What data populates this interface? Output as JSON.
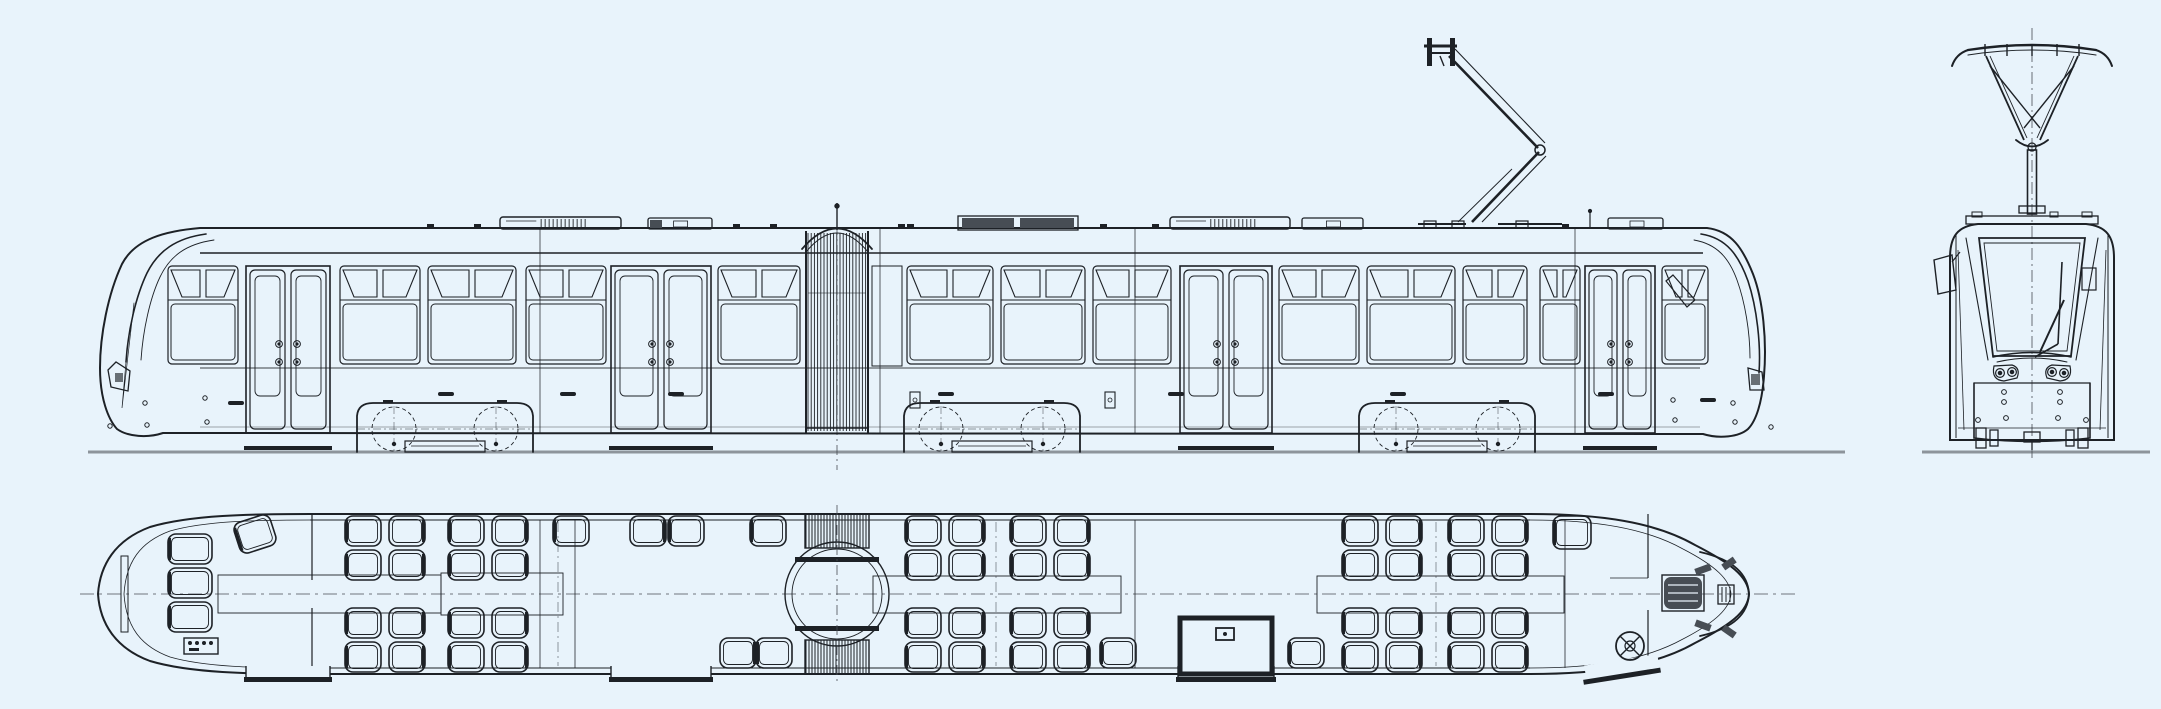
{
  "canvas": {
    "width": 2161,
    "height": 709,
    "background": "#e8f3fb",
    "ink": "#1d2126",
    "ink_soft": "#474d54",
    "ground": "#8d949b"
  },
  "side_view": {
    "rail_y": 452,
    "roof_y": 228,
    "body_bottom": 433,
    "fascia_y": 253,
    "waist_y": 368,
    "body": {
      "left_tip": 100,
      "right_tip": 1764,
      "roof_left": 200,
      "roof_right": 1707
    },
    "center_mark_x": 837,
    "windows": [
      {
        "x": 166,
        "w": 74
      },
      {
        "x": 338,
        "w": 84
      },
      {
        "x": 426,
        "w": 92
      },
      {
        "x": 524,
        "w": 84
      },
      {
        "x": 716,
        "w": 86
      },
      {
        "x": 905,
        "w": 90
      },
      {
        "x": 999,
        "w": 88
      },
      {
        "x": 1091,
        "w": 82
      },
      {
        "x": 1277,
        "w": 84
      },
      {
        "x": 1365,
        "w": 92
      },
      {
        "x": 1461,
        "w": 68
      },
      {
        "x": 1538,
        "w": 44
      },
      {
        "x": 1660,
        "w": 50
      }
    ],
    "doors": [
      {
        "x": 246,
        "w": 84
      },
      {
        "x": 611,
        "w": 100
      },
      {
        "x": 1180,
        "w": 92
      },
      {
        "x": 1585,
        "w": 70
      }
    ],
    "filler_panels": [
      {
        "x": 872,
        "w": 30
      }
    ],
    "bogies": [
      {
        "cx": 445
      },
      {
        "cx": 992
      },
      {
        "cx": 1447
      }
    ],
    "bellows": {
      "x": 806,
      "w": 62,
      "dome_peak_y": 212,
      "spike_top_y": 203
    },
    "roof_units": [
      {
        "type": "louver",
        "x": 500,
        "w": 121
      },
      {
        "type": "box",
        "x": 648,
        "w": 64,
        "dark_end": "w"
      },
      {
        "type": "dark",
        "x": 958,
        "w": 120
      },
      {
        "type": "louver",
        "x": 1170,
        "w": 120
      },
      {
        "type": "box",
        "x": 1302,
        "w": 61
      },
      {
        "type": "box",
        "x": 1608,
        "w": 55
      }
    ],
    "roof_vents": [
      427,
      474,
      733,
      770,
      898,
      907,
      1100,
      1152,
      1562
    ],
    "antenna_x": 1590,
    "handles": [
      438,
      560,
      668,
      938,
      1168,
      1390,
      1598
    ],
    "latch_boxes": [
      910,
      1105
    ],
    "joints": [
      540,
      880,
      1135,
      1575
    ]
  },
  "front_view": {
    "cx": 2032,
    "rail_y": 452,
    "body": {
      "left": 1950,
      "right": 2114,
      "top": 224,
      "bottom": 440
    },
    "windshield": [
      [
        1979,
        238
      ],
      [
        2085,
        238
      ],
      [
        2071,
        356
      ],
      [
        1993,
        356
      ]
    ],
    "windshield_inner": [
      [
        1984,
        243
      ],
      [
        2080,
        243
      ],
      [
        2067,
        351
      ],
      [
        1997,
        351
      ]
    ],
    "headlight_centers": [
      [
        2000,
        373
      ],
      [
        2012,
        372
      ],
      [
        2052,
        372
      ],
      [
        2064,
        373
      ]
    ],
    "bumper_dots": [
      [
        2004,
        392
      ],
      [
        2060,
        392
      ],
      [
        2004,
        402
      ],
      [
        2060,
        402
      ],
      [
        2006,
        418
      ],
      [
        2058,
        418
      ],
      [
        1978,
        420
      ],
      [
        2086,
        420
      ]
    ],
    "mirror": [
      [
        1934,
        260
      ],
      [
        1952,
        255
      ],
      [
        1956,
        290
      ],
      [
        1938,
        294
      ]
    ],
    "dest_box": {
      "x": 2082,
      "y": 268,
      "w": 14,
      "h": 22
    },
    "pantograph": {
      "bow_y": 46,
      "bow_half": 64,
      "frame_bot_y": 140,
      "mast_top": 150,
      "mast_bottom": 214
    }
  },
  "plan_view": {
    "center_y": 594,
    "top_wall": 514,
    "bottom_wall": 674,
    "left_tip": 98,
    "right_tip": 1749,
    "straight": [
      310,
      1530
    ],
    "aisles": [
      {
        "x": 218,
        "y": 575,
        "w": 223,
        "h": 38
      },
      {
        "x": 441,
        "y": 573,
        "w": 122,
        "h": 42
      },
      {
        "x": 873,
        "y": 576,
        "w": 248,
        "h": 37
      },
      {
        "x": 1317,
        "y": 576,
        "w": 247,
        "h": 37
      }
    ],
    "bogie_marks": [
      558,
      996,
      1436
    ],
    "partitions": [
      540,
      575,
      1135,
      1565
    ],
    "articulation": {
      "x": 805,
      "w": 64,
      "cx": 837,
      "r_outer": 52,
      "r_inner": 45
    },
    "doors": [
      {
        "x": 246,
        "w": 84,
        "style": "plain"
      },
      {
        "x": 611,
        "w": 100,
        "style": "plain"
      },
      {
        "x": 1178,
        "w": 96,
        "style": "framed"
      },
      {
        "x": 1585,
        "w": 70,
        "style": "slanted"
      }
    ],
    "seat_quads_top": [
      345,
      448,
      905,
      1010,
      1342,
      1448
    ],
    "seat_quads_bottom": [
      345,
      448,
      905,
      1010,
      1342,
      1448
    ],
    "seat_singles": [
      {
        "x": 553,
        "y": 516,
        "back": "w"
      },
      {
        "x": 630,
        "y": 516,
        "back": "e"
      },
      {
        "x": 668,
        "y": 516,
        "back": "w"
      },
      {
        "x": 750,
        "y": 516,
        "back": "w"
      },
      {
        "x": 1553,
        "y": 516,
        "back": "w",
        "w": 38,
        "h": 33
      },
      {
        "x": 720,
        "y": 638,
        "back": "e"
      },
      {
        "x": 756,
        "y": 638,
        "back": "w"
      },
      {
        "x": 1100,
        "y": 638,
        "back": "w"
      },
      {
        "x": 1288,
        "y": 638,
        "back": "w"
      }
    ],
    "cab_left": {
      "seat_column_x": 168,
      "seat_rows": [
        534,
        568,
        602
      ],
      "panel": {
        "x": 184,
        "y": 638,
        "w": 34,
        "h": 16
      },
      "window": {
        "x": 121,
        "y": 556,
        "w": 7,
        "h": 76
      },
      "diagonal_seat": {
        "x": 236,
        "y": 518,
        "rot": -18
      },
      "partition_x": 312
    },
    "cab_right": {
      "partition_x": 1648,
      "console": {
        "x": 1664,
        "y": 577,
        "w": 38,
        "h": 32
      },
      "panel": {
        "x": 1718,
        "y": 585,
        "w": 16,
        "h": 19
      },
      "handwheel": {
        "cx": 1630,
        "cy": 646,
        "r": 14
      },
      "vents": [
        [
          1695,
          566,
          16,
          7,
          -20
        ],
        [
          1722,
          560,
          14,
          7,
          -35
        ],
        [
          1722,
          628,
          14,
          7,
          35
        ],
        [
          1695,
          622,
          16,
          7,
          20
        ]
      ]
    }
  }
}
